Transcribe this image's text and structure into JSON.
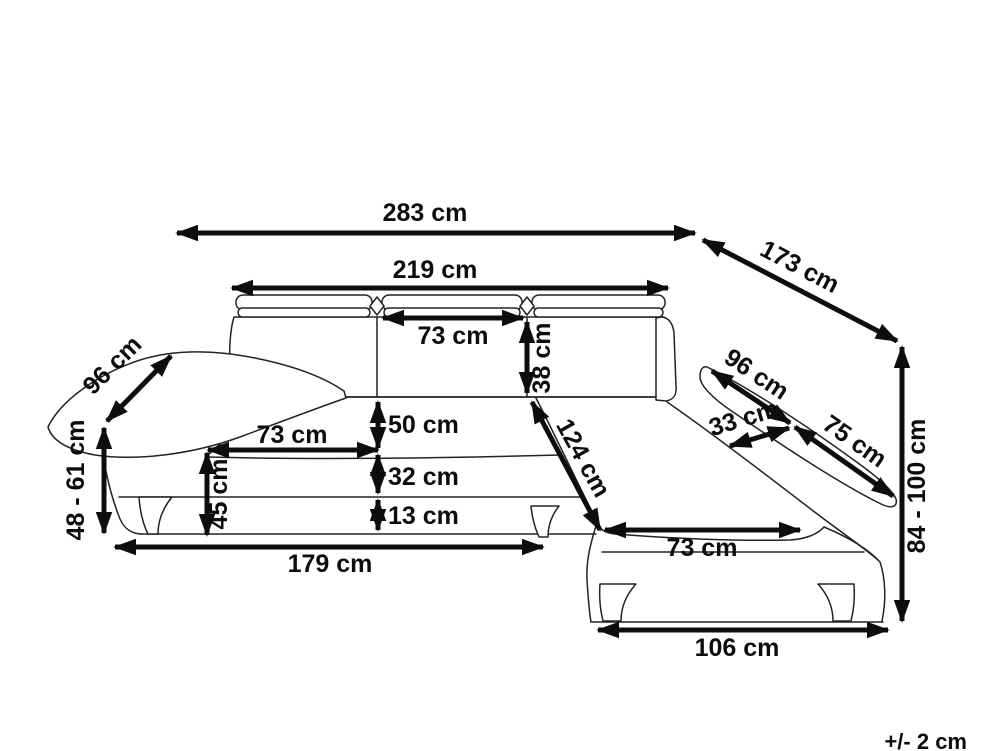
{
  "diagram": {
    "kind": "corner-sofa-dimension-drawing",
    "unit": "cm",
    "colors": {
      "line": "#232323",
      "dimension": "#0d0d0d",
      "background": "#ffffff"
    },
    "labels": {
      "overall_width": "283 cm",
      "back_width": "219 cm",
      "headrest_width": "73 cm",
      "headrest_height": "38 cm",
      "left_armrest_length": "96 cm",
      "depth_diagonal": "173 cm",
      "armrest_height_range": "48 - 61 cm",
      "seat_cushion_width": "73 cm",
      "backrest_above_seat": "50 cm",
      "seat_front_height": "32 cm",
      "base_clearance": "13 cm",
      "seat_height": "45 cm",
      "base_width": "179 cm",
      "chaise_length": "124 cm",
      "chaise_arm_width": "33 cm",
      "chaise_arm_back_length": "96 cm",
      "chaise_arm_front_length": "75 cm",
      "overall_height_range": "84 - 100 cm",
      "chaise_seat_width": "73 cm",
      "chaise_base_depth": "106 cm",
      "tolerance": "+/- 2 cm"
    }
  }
}
